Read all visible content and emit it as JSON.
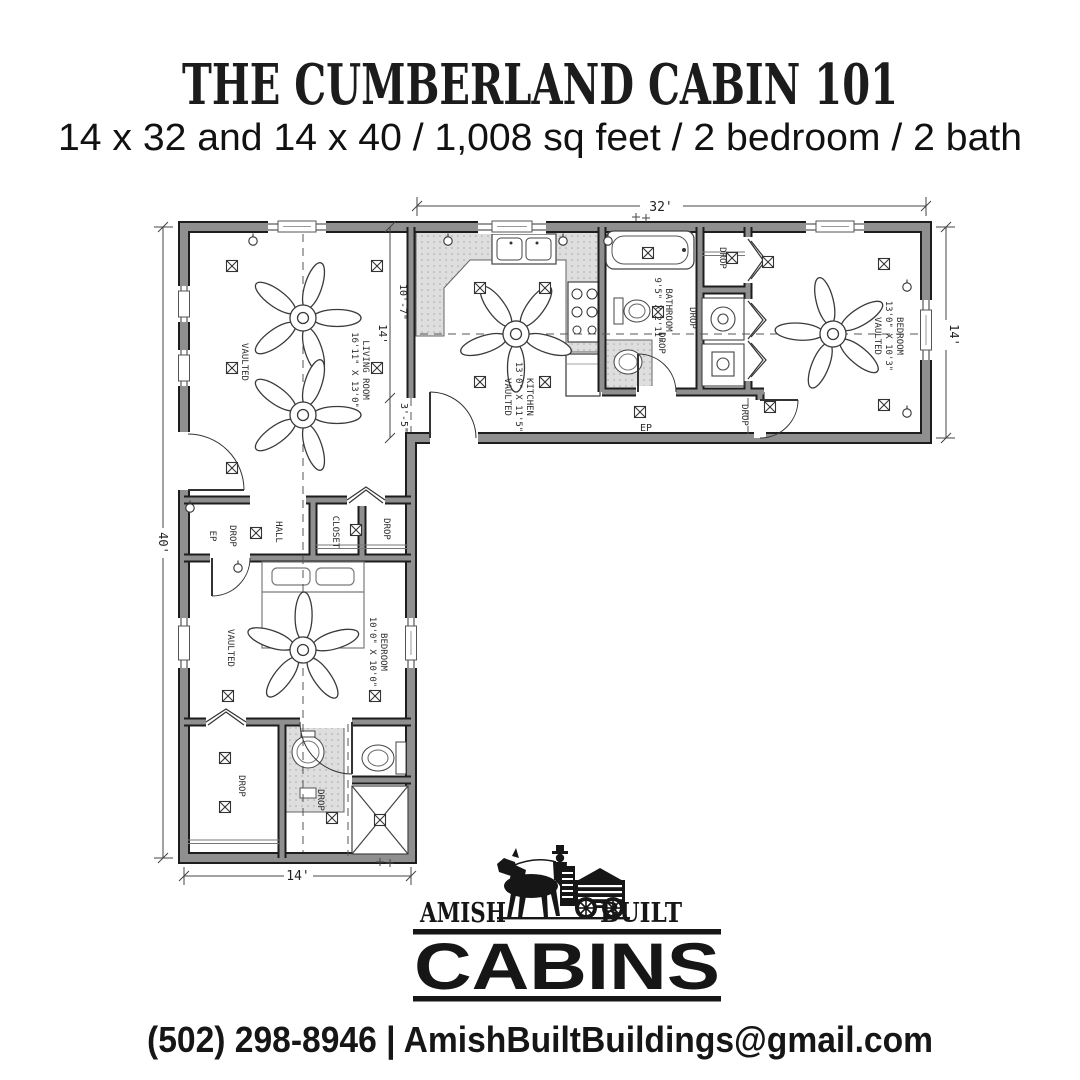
{
  "header": {
    "title": "THE CUMBERLAND CABIN 101",
    "subtitle": "14 x 32 and 14 x 40 / 1,008 sq feet / 2 bedroom / 2 bath"
  },
  "plan": {
    "dims": {
      "top": "32'",
      "right": "14'",
      "left": "40'",
      "bottom": "14'",
      "seg_total": "14'",
      "seg_upper": "10'-7\"",
      "seg_lower": "3'-5\""
    },
    "rooms": {
      "living": {
        "name": "LIVING ROOM",
        "dims": "16'11\" X 13'0\"",
        "note": "VAULTED"
      },
      "kitchen": {
        "name": "KITCHEN",
        "dims": "13'0\" X 11'5\"",
        "note": "VAULTED"
      },
      "bathroom": {
        "name": "BATHROOM",
        "dims": "9'5\" X 2'11\""
      },
      "bedroom_main": {
        "name": "BEDROOM",
        "dims": "13'0\" X 10'3\"",
        "note": "VAULTED"
      },
      "bedroom_second": {
        "name": "BEDROOM",
        "dims": "10'0\" X 10'0\"",
        "note": "VAULTED"
      },
      "hall": {
        "name": "HALL"
      },
      "closet": {
        "name": "CLOSET"
      }
    },
    "labels": {
      "drop": "DROP",
      "ep": "EP"
    }
  },
  "logo": {
    "amish": "AMISH",
    "built": "BUILT",
    "cabins": "CABINS"
  },
  "footer": {
    "contact": "(502) 298-8946 | AmishBuiltBuildings@gmail.com"
  },
  "colors": {
    "ink": "#1a1a1a",
    "wall": "#8f8f8f",
    "counter": "#d9d9d9"
  }
}
